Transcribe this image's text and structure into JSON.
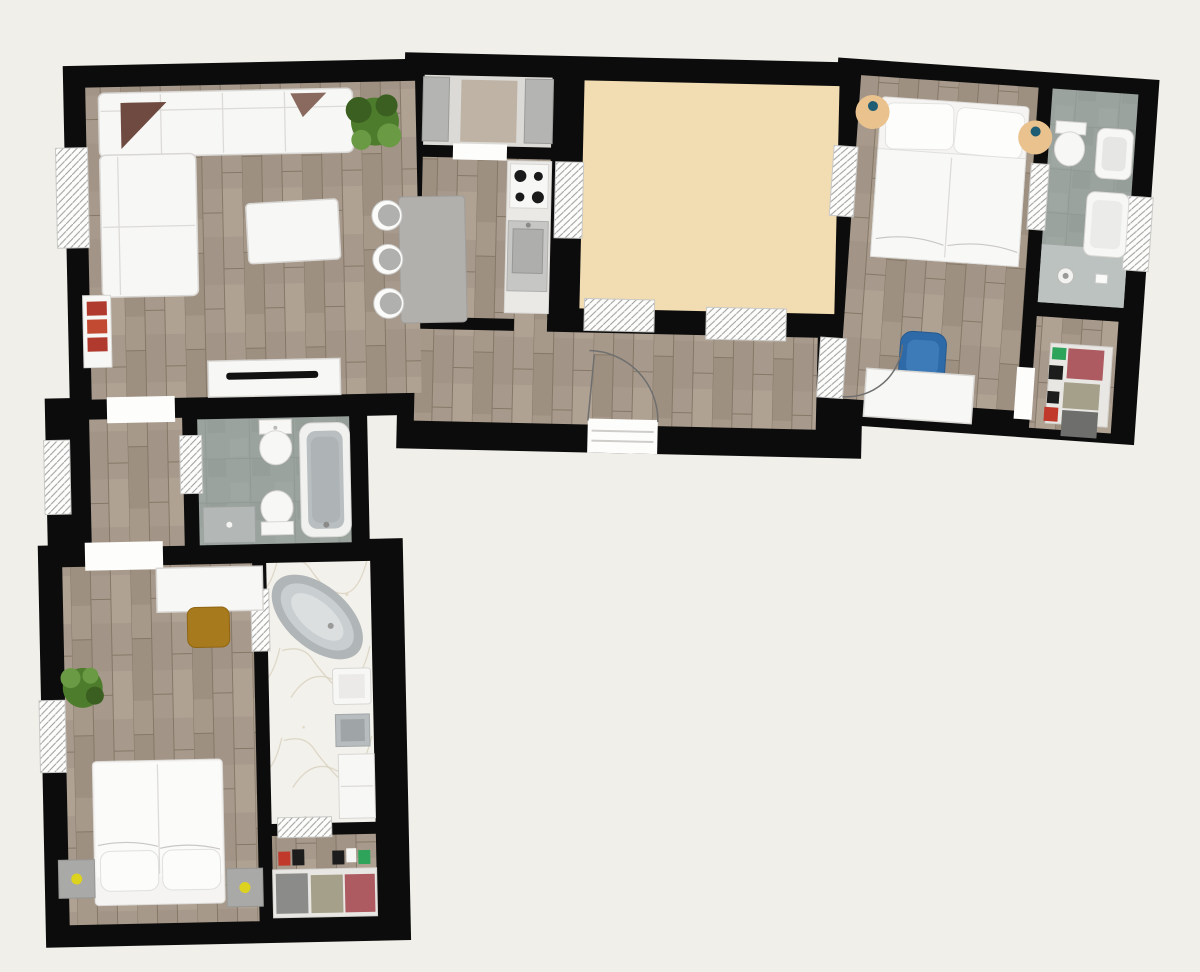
{
  "title": "apartment-floor-plan-top-view",
  "colors": {
    "background": "#f1efe9",
    "wall": "#0c0c0c",
    "woodBase": "#a79a8c",
    "woodDark": "#968878",
    "woodLight": "#b6a998",
    "woodLine": "#857867",
    "tile": "#9ba39e",
    "tileDark": "#87908b",
    "tileLight": "#bcc2bf",
    "marble": "#f3f1ec",
    "marbleVein": "#d9d2c0",
    "terrace": "#f2dcb2",
    "pantryFloor": "#dcdad6",
    "white": "#f7f7f5",
    "stroke": "#d9d7d4",
    "grayFurn": "#b4b4b2",
    "grayDark": "#9b9b99",
    "arc": "#6f6f6f",
    "plant": "#4e7c2d",
    "plantDark": "#3a5f20",
    "plantLight": "#6a9a44",
    "accentRed": "#b03a2e",
    "chairBlue": "#2e6aa7",
    "chairBlueLight": "#3d7ab8",
    "nightstandTan": "#eac28e",
    "lampTeal": "#1f5d74",
    "lampYellow": "#ddd31f",
    "chairBrown": "#a87a1e",
    "basketRed": "#ad5a60",
    "basketOlive": "#a5a089",
    "basketGray": "#8b8b89",
    "basketDark": "#6e6e6c",
    "itemGreen": "#2ea35a",
    "itemRed": "#c0392b",
    "itemBlack": "#1c1c1c",
    "pillowMaroon": "#6e4a40",
    "tubRim": "#b0b5b7",
    "tubMid": "#c9ced0",
    "tubInner": "#dbdfe0"
  },
  "legend": {
    "walls": "solid black bands",
    "windows": "white hatched openings in walls",
    "doors": "white gaps with quarter-circle swing arcs"
  },
  "rooms": [
    {
      "id": "living-room",
      "floor": "wood",
      "furniture": [
        "corner-sofa",
        "accent-pillows",
        "coffee-table",
        "potted-plant",
        "radiator-shelf",
        "tv-stand",
        "television"
      ]
    },
    {
      "id": "kitchen",
      "floor": "wood",
      "furniture": [
        "island-counter",
        "bar-stools-x3",
        "stove-4-burner",
        "kitchen-sink",
        "counter-run"
      ]
    },
    {
      "id": "pantry",
      "floor": "light-gray",
      "furniture": [
        "side-counters",
        "runner-rug"
      ]
    },
    {
      "id": "terrace-room",
      "floor": "plain-beige",
      "furniture": []
    },
    {
      "id": "hallway",
      "floor": "wood",
      "furniture": []
    },
    {
      "id": "bedroom-right",
      "floor": "wood",
      "furniture": [
        "double-bed",
        "pillows-x2",
        "round-nightstand-left",
        "round-nightstand-right",
        "blue-armchair",
        "desk"
      ]
    },
    {
      "id": "bathroom-right",
      "floor": "gray-tile",
      "furniture": [
        "toilet",
        "washbasin",
        "bathtub-basin",
        "walk-in-shower"
      ]
    },
    {
      "id": "closet-right",
      "floor": "wood",
      "furniture": [
        "shelf-with-baskets"
      ]
    },
    {
      "id": "bathroom-middle",
      "floor": "gray-tile",
      "furniture": [
        "bathtub",
        "toilet",
        "bidet",
        "vanity"
      ]
    },
    {
      "id": "corridor-left",
      "floor": "wood",
      "furniture": []
    },
    {
      "id": "bedroom-bottom",
      "floor": "wood",
      "furniture": [
        "double-bed",
        "pillows-x2",
        "nightstand-left",
        "nightstand-right",
        "desk",
        "wooden-chair",
        "potted-plant"
      ]
    },
    {
      "id": "bathroom-bottom",
      "floor": "marble",
      "furniture": [
        "freestanding-oval-tub",
        "washbasin-white",
        "washbasin-gray",
        "storage-cabinet"
      ]
    },
    {
      "id": "closet-bottom",
      "floor": "wood",
      "furniture": [
        "shelf-with-baskets"
      ]
    }
  ]
}
